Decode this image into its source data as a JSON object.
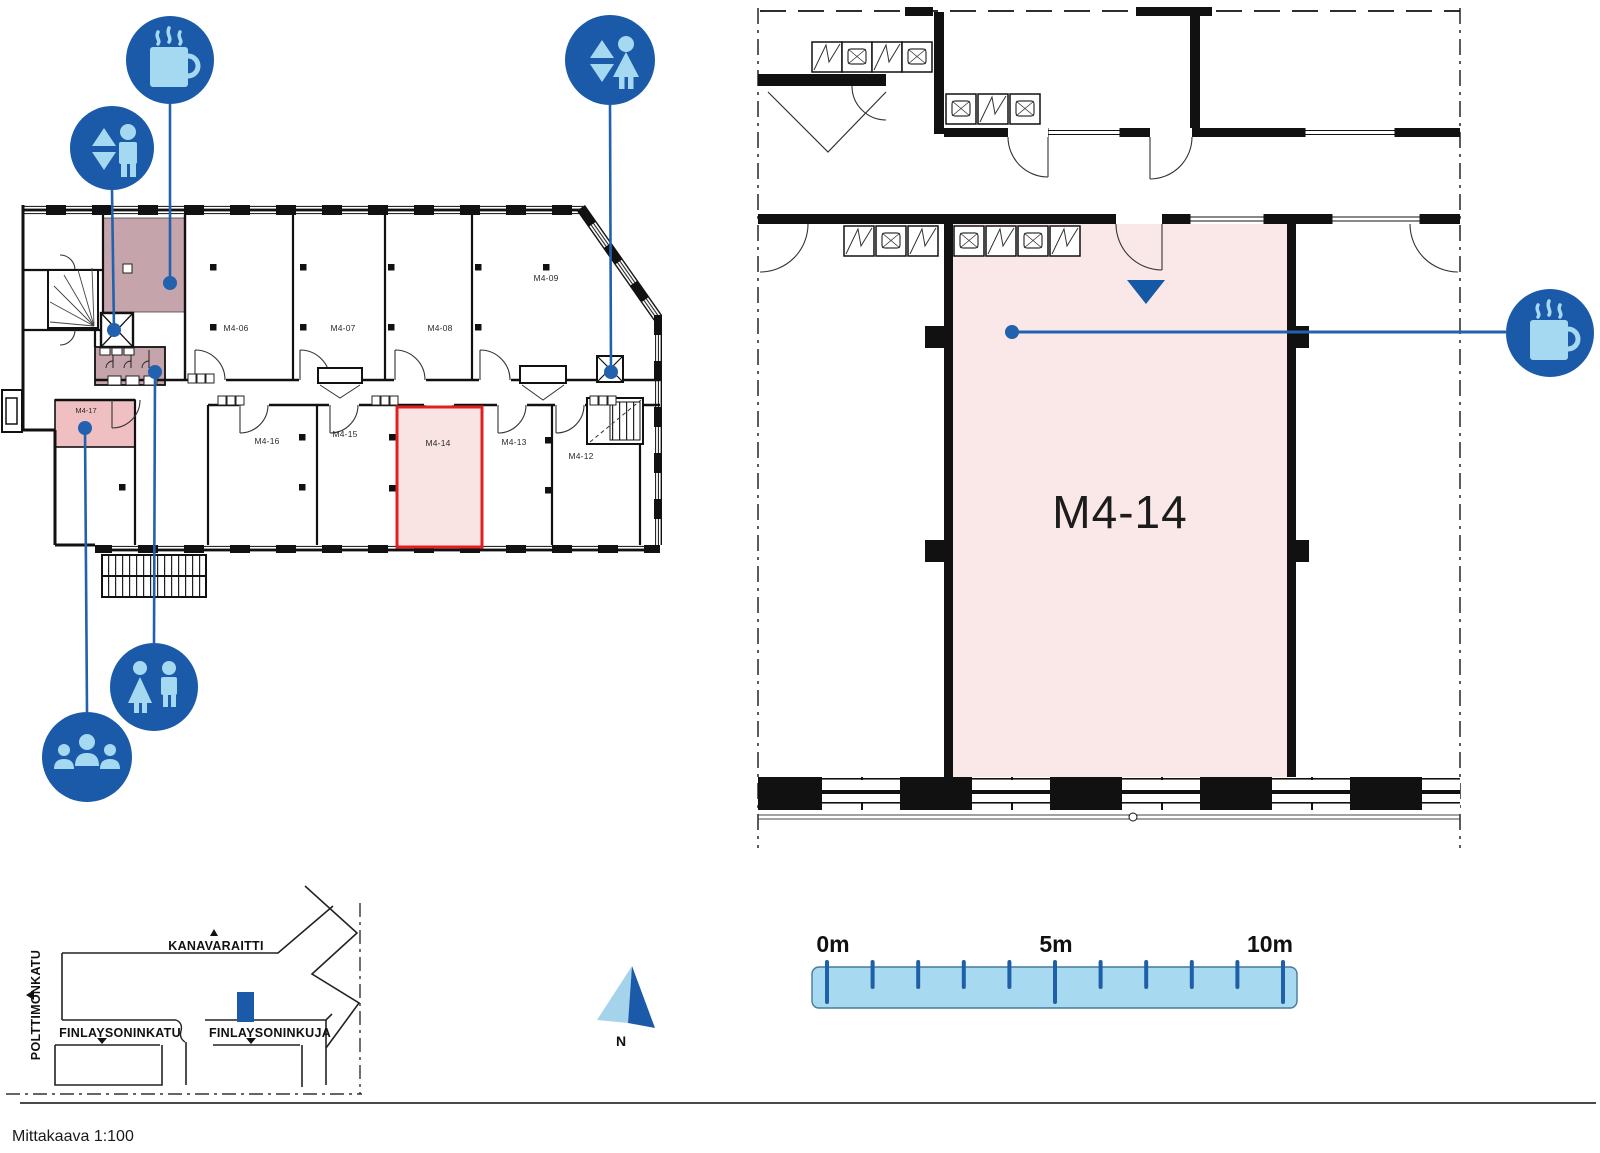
{
  "overview_plan": {
    "rooms": {
      "m4_06": "M4-06",
      "m4_07": "M4-07",
      "m4_08": "M4-08",
      "m4_09": "M4-09",
      "m4_12": "M4-12",
      "m4_13": "M4-13",
      "m4_14": "M4-14",
      "m4_15": "M4-15",
      "m4_16": "M4-16",
      "m4_17": "M4-17"
    },
    "highlighted_room": "M4-14",
    "amenity_icons": [
      {
        "name": "coffee-station-icon"
      },
      {
        "name": "elevator-icon"
      },
      {
        "name": "elevator-icon"
      },
      {
        "name": "wc-icon"
      },
      {
        "name": "meeting-point-icon"
      }
    ]
  },
  "detail_plan": {
    "room_label": "M4-14",
    "amenity_icons": [
      {
        "name": "coffee-station-icon"
      }
    ],
    "entrance_marker": "triangle-down"
  },
  "site_map": {
    "streets": {
      "north": "KANAVARAITTI",
      "west": "POLTTIMONKATU",
      "south_west": "FINLAYSONINKATU",
      "south_east": "FINLAYSONINKUJA"
    }
  },
  "compass": {
    "north_label": "N"
  },
  "scale_bar": {
    "tick_labels": [
      "0m",
      "5m",
      "10m"
    ]
  },
  "footer": {
    "caption": "Mittakaava 1:100"
  },
  "colors": {
    "brand_blue": "#1a5aa9",
    "accent_dark_blue": "#1558a5",
    "connector_blue": "#2261ae",
    "light_blue": "#a5d8f1",
    "highlight_red": "#e02020",
    "room_pink": "#f9e8e7",
    "room_pink_strong": "#f0bfc1",
    "common_area_mauve": "#c6a4ab",
    "wall_black": "#111111"
  }
}
